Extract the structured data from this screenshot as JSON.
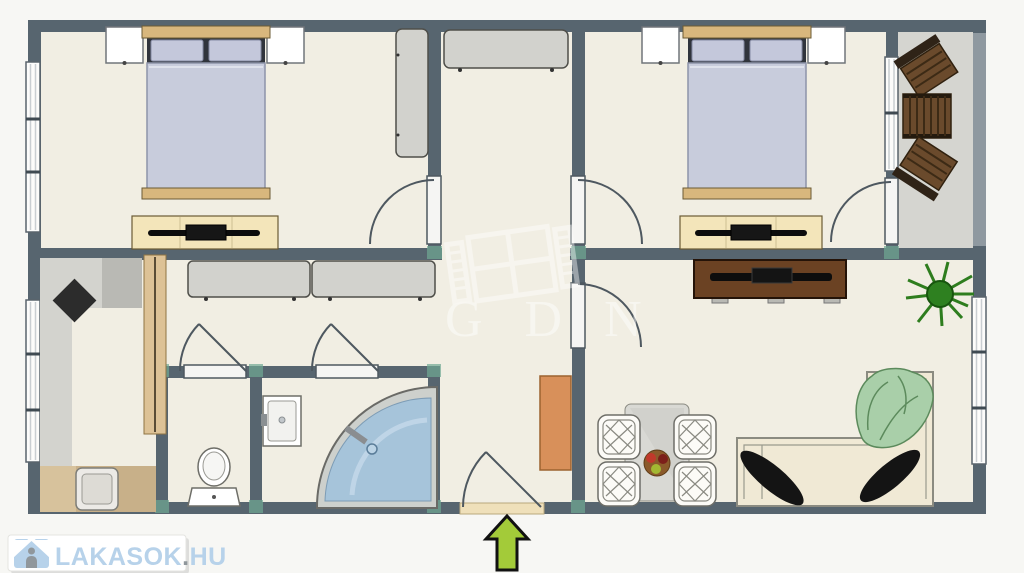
{
  "watermark": {
    "text": "GDN"
  },
  "logo": {
    "brand": "LAKASOK",
    "separator": ".",
    "tld": "HU",
    "full_text": "LAKASOK.HU"
  },
  "colors": {
    "wall": "#57656f",
    "floor": "#f1eee3",
    "balcony_floor": "#d5d5d0",
    "bed_linen": "#c8ccdc",
    "wood_trim": "#d8b77d",
    "dresser_cream": "#f3e5ba",
    "cabinet_gray": "#d2d2cd",
    "balcony_wood": "#6a4a2c",
    "tv_console_brown": "#6b4223",
    "sofa_cream": "#f0e9d5",
    "blanket_green": "#a9cfa9",
    "plant_green": "#2e8020",
    "shower_blue": "#a6c4da",
    "entry_arrow_green": "#a3cb39",
    "hall_cabinet_orange": "#d8905a",
    "sliding_door_tan": "#ddc296",
    "corner_marker_teal": "#6fa893",
    "logo_blue": "#b7d2ea",
    "logo_gray": "#90979c"
  },
  "furniture_icons": [
    "double-bed",
    "pillow",
    "nightstand",
    "dresser-with-tv",
    "wardrobe",
    "window",
    "door-swing",
    "sliding-door",
    "kitchen-counter",
    "kitchen-sink",
    "hob-diamond",
    "toilet",
    "washbasin",
    "corner-shower",
    "dining-table",
    "wicker-chair",
    "fruit-bowl",
    "l-shaped-sofa",
    "throw-blanket",
    "cushion",
    "tv-console",
    "potted-plant",
    "balcony-chair",
    "balcony-table",
    "entry-arrow"
  ]
}
